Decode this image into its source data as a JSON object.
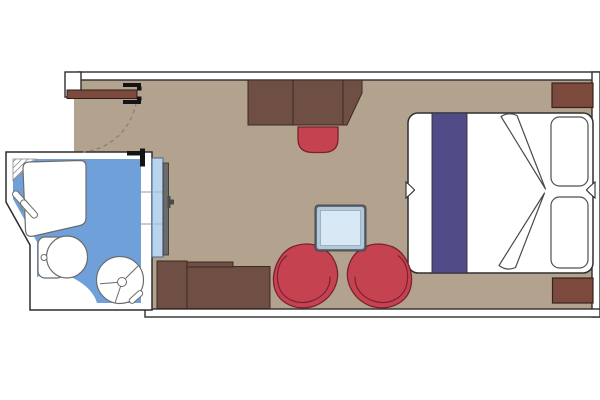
{
  "canvas": {
    "width": 600,
    "height": 400,
    "background": "#ffffff"
  },
  "diagram_type": "cruise-cabin-floorplan",
  "colors": {
    "wall_fill": "#ffffff",
    "wall_outline": "#2d2d2d",
    "floor": "#b3a28d",
    "bathroom_floor": "#6fa0d9",
    "fixture_outline": "#6b6b6b",
    "fixture_fill": "#ffffff",
    "wood_dark": "#6f4e43",
    "wood_red": "#7b4a3c",
    "door_leaf": "#7d4a3e",
    "swing_arc": "#8b8070",
    "upholstery_red": "#c54350",
    "upholstery_outline": "#7a2030",
    "bed_runner": "#504c88",
    "bed_outline": "#2f2f2f",
    "table_border": "#5d6e7e",
    "table_mid": "#b5c8d8",
    "table_top": "#d9e8f5",
    "panel_blue": "#b9d4ee",
    "panel_gray": "#6b6b6b",
    "frame_marks": "#141414",
    "hatch": "#8a8a8a"
  },
  "features": [
    "entrance-door",
    "door-swing-arc",
    "bathroom",
    "shower-tub",
    "shower-faucet",
    "toilet",
    "washbasin",
    "sliding-door",
    "vanity-desk",
    "stool",
    "dresser-unit",
    "coffee-table",
    "armchair-left",
    "armchair-right",
    "double-bed",
    "bed-runner",
    "pillow",
    "nightstand"
  ]
}
